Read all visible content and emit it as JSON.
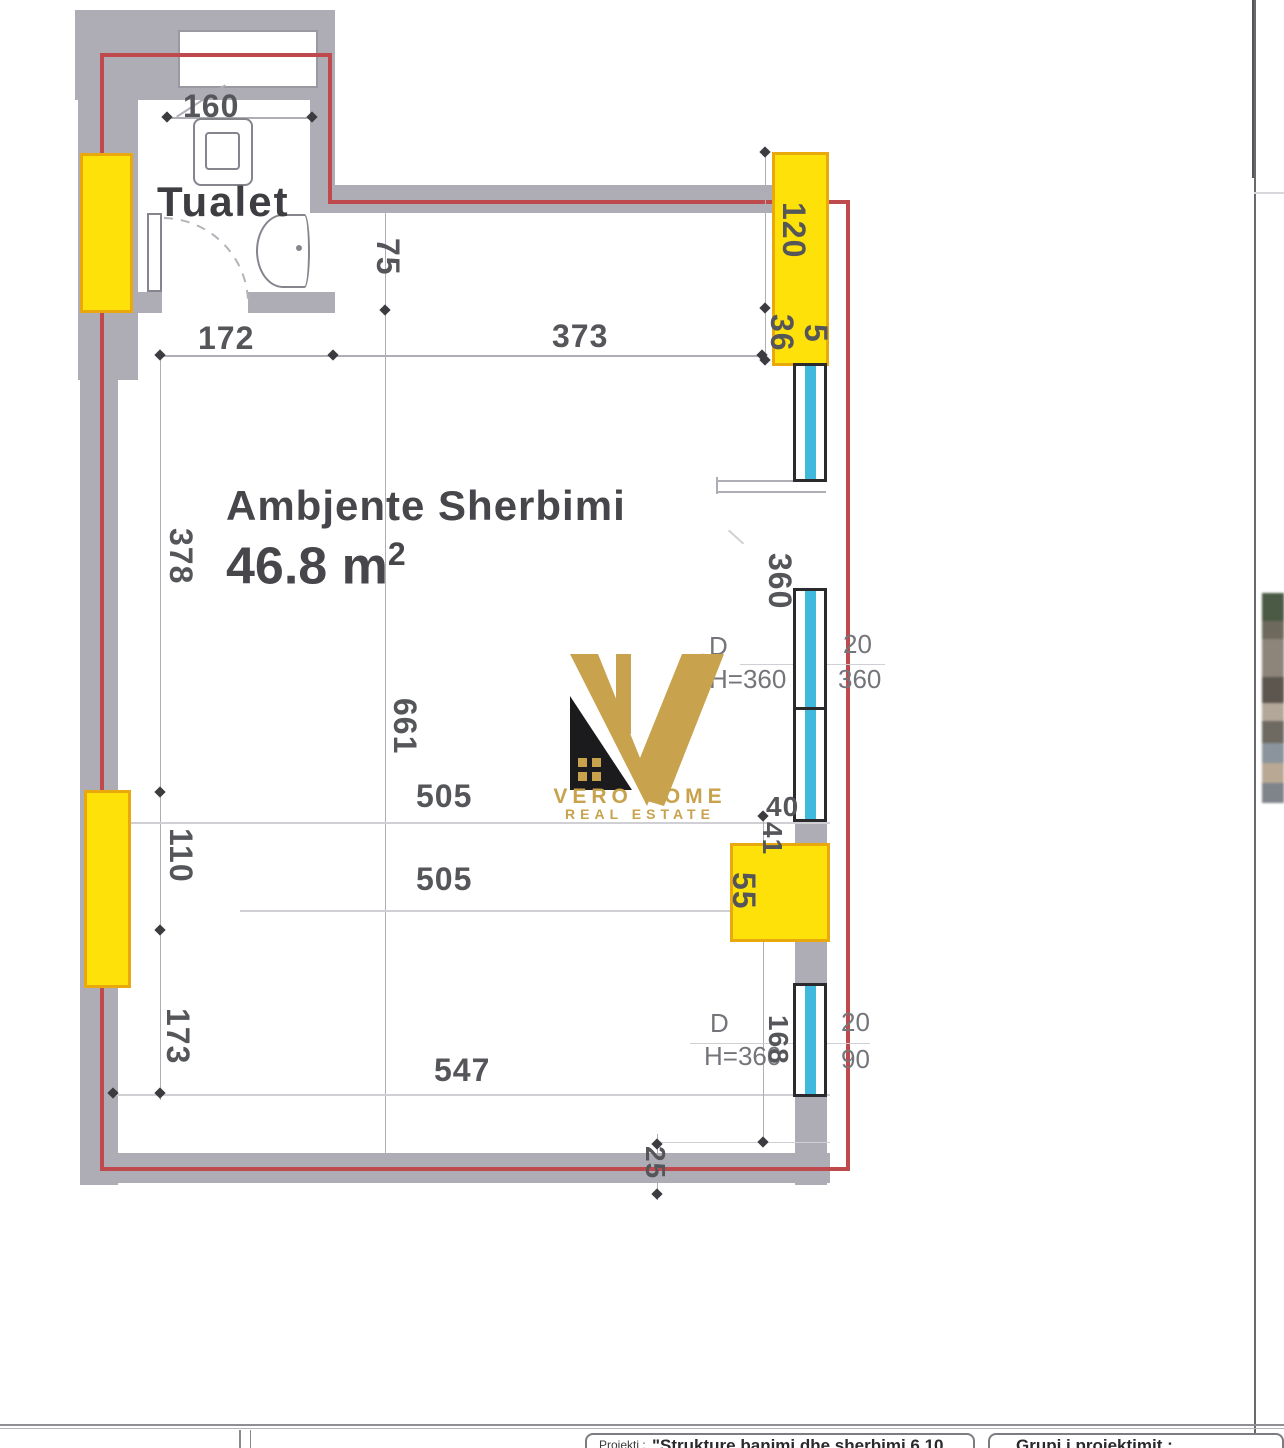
{
  "plan": {
    "room_name": "Ambjente Sherbimi",
    "room_area": "46.8 m",
    "room_area_exp": "2",
    "bathroom_label": "Tualet",
    "dims": {
      "d160": "160",
      "d172": "172",
      "d373": "373",
      "d75": "75",
      "d120": "120",
      "d36": "36",
      "d5": "5",
      "d378": "378",
      "d360_side": "360",
      "d20_a": "20",
      "d360_b": "360",
      "door1_d": "D",
      "door1_h": "H=360",
      "d661": "661",
      "d505_a": "505",
      "d505_b": "505",
      "d40": "40",
      "d41": "41",
      "d55": "55",
      "d110": "110",
      "d173": "173",
      "d547": "547",
      "door2_d": "D",
      "door2_h": "H=360",
      "d168": "168",
      "d20_b": "20",
      "d90": "90",
      "d25": "25"
    }
  },
  "logo": {
    "reg": "R",
    "line1": "VERO HOME",
    "line2": "REAL ESTATE"
  },
  "titleblock": {
    "project_label": "Projekti :",
    "project_value": "\"Strukture banimi dhe sherbimi 6.10",
    "group_label": "Grupi i projektimit :"
  },
  "colors": {
    "wall_gray": "#AEADB6",
    "line_red": "#BE4A4D",
    "column_yellow": "#FFE10A",
    "column_border": "#E9A80C",
    "window_cyan": "#41B9DC",
    "dim_text": "#55565A",
    "logo_gold": "#C8A24C",
    "logo_black": "#1B1B1D"
  }
}
